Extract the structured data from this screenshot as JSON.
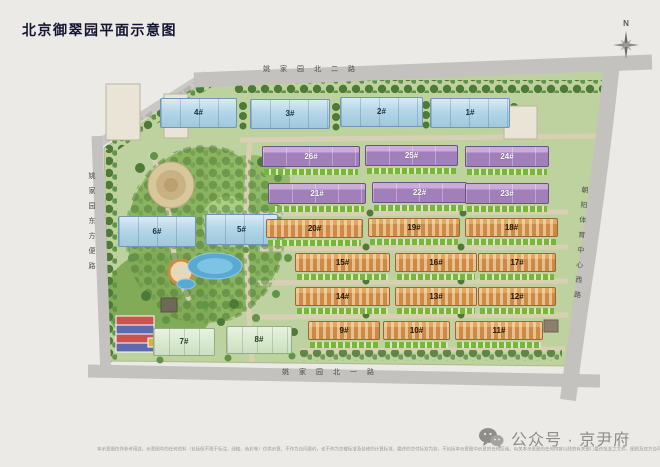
{
  "title": "北京御翠园平面示意图",
  "compass": {
    "label": "N"
  },
  "roads": {
    "top": "姚家园北二路",
    "bottom": "姚家园北一路",
    "left": "姚家园东方便路",
    "right": "朝阳体育中心西路"
  },
  "buildings": [
    {
      "label": "1#",
      "category": "highrise-blue"
    },
    {
      "label": "2#",
      "category": "highrise-blue"
    },
    {
      "label": "3#",
      "category": "highrise-blue"
    },
    {
      "label": "4#",
      "category": "highrise-blue"
    },
    {
      "label": "5#",
      "category": "highrise-blue"
    },
    {
      "label": "6#",
      "category": "highrise-blue"
    },
    {
      "label": "7#",
      "category": "lowrise-green"
    },
    {
      "label": "8#",
      "category": "lowrise-green"
    },
    {
      "label": "9#",
      "category": "townhouse-orange"
    },
    {
      "label": "10#",
      "category": "townhouse-orange"
    },
    {
      "label": "11#",
      "category": "townhouse-orange"
    },
    {
      "label": "12#",
      "category": "townhouse-orange"
    },
    {
      "label": "13#",
      "category": "townhouse-orange"
    },
    {
      "label": "14#",
      "category": "townhouse-orange"
    },
    {
      "label": "15#",
      "category": "townhouse-orange"
    },
    {
      "label": "16#",
      "category": "townhouse-orange"
    },
    {
      "label": "17#",
      "category": "townhouse-orange"
    },
    {
      "label": "18#",
      "category": "townhouse-orange"
    },
    {
      "label": "19#",
      "category": "townhouse-orange"
    },
    {
      "label": "20#",
      "category": "townhouse-orange"
    },
    {
      "label": "21#",
      "category": "townhouse-purple"
    },
    {
      "label": "22#",
      "category": "townhouse-purple"
    },
    {
      "label": "23#",
      "category": "townhouse-purple"
    },
    {
      "label": "24#",
      "category": "townhouse-purple"
    },
    {
      "label": "25#",
      "category": "townhouse-purple"
    },
    {
      "label": "26#",
      "category": "townhouse-purple"
    }
  ],
  "footer": {
    "disclaimer": "本示意图仅作参考用途，示意图中的任何资料（包括但不限于标注、绿植、色彩等）仅供示意，不作为合同要约，也不作为交楼标准及装修的计算标准，最终的交付标准为准，不包括本示意图中示意的任何区域。有关本示意图的任何内容以政府有关部门最终批准之文件、图则及双方合同约定为准。",
    "wechat_label": "公众号 · 京尹府"
  },
  "palette": {
    "road": "#c3c2be",
    "site_green": "#bed2a0",
    "highrise_blue": "#b4d6e8",
    "lowrise_green": "#cbe0c0",
    "townhouse_orange": "#cc8a46",
    "townhouse_purple": "#a180b9",
    "hedge_green": "#74b836",
    "water_blue": "#5aa9d3"
  }
}
